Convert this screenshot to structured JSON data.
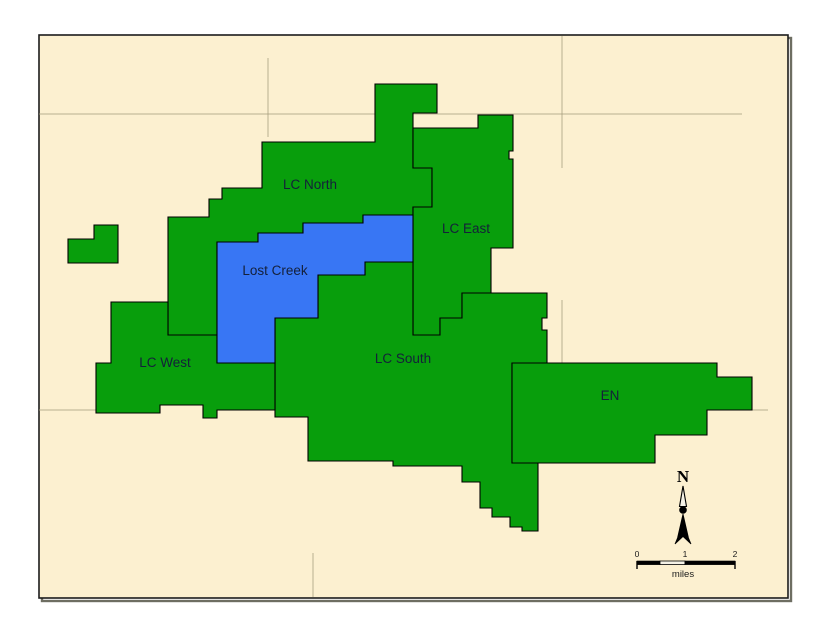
{
  "figure": {
    "type": "map",
    "title": "Lost Creek project areas map",
    "colors": {
      "page_bg": "#ffffff",
      "map_bg": "#FCF0D0",
      "green": "#089E0C",
      "blue": "#3876F4",
      "outline": "#000000",
      "frame": "#1c1c1c",
      "frame_shadow": "#6e6e62",
      "gridline": "#a89f7e",
      "label_text": "#14203a"
    },
    "frame": {
      "x": 39,
      "y": 35,
      "width": 749,
      "height": 563
    },
    "areas": [
      {
        "id": "lc-north",
        "label": "LC North",
        "fill": "green",
        "label_x": 310,
        "label_y": 189,
        "points": [
          [
            262,
            142
          ],
          [
            375,
            142
          ],
          [
            375,
            84
          ],
          [
            437,
            84
          ],
          [
            437,
            113
          ],
          [
            413,
            113
          ],
          [
            413,
            168
          ],
          [
            432,
            168
          ],
          [
            432,
            207
          ],
          [
            413,
            207
          ],
          [
            413,
            215
          ],
          [
            363,
            215
          ],
          [
            363,
            223
          ],
          [
            303,
            223
          ],
          [
            303,
            233
          ],
          [
            258,
            233
          ],
          [
            258,
            242
          ],
          [
            217,
            242
          ],
          [
            217,
            335
          ],
          [
            168,
            335
          ],
          [
            168,
            217
          ],
          [
            209,
            217
          ],
          [
            209,
            199
          ],
          [
            222,
            199
          ],
          [
            222,
            188
          ],
          [
            262,
            188
          ]
        ]
      },
      {
        "id": "lc-east",
        "label": "LC East",
        "fill": "green",
        "label_x": 466,
        "label_y": 233,
        "points": [
          [
            478,
            115
          ],
          [
            513,
            115
          ],
          [
            513,
            151
          ],
          [
            509,
            151
          ],
          [
            509,
            159
          ],
          [
            513,
            159
          ],
          [
            513,
            248
          ],
          [
            491,
            248
          ],
          [
            491,
            293
          ],
          [
            462,
            293
          ],
          [
            462,
            318
          ],
          [
            440,
            318
          ],
          [
            440,
            335
          ],
          [
            413,
            335
          ],
          [
            413,
            207
          ],
          [
            432,
            207
          ],
          [
            432,
            168
          ],
          [
            413,
            168
          ],
          [
            413,
            128
          ],
          [
            478,
            128
          ]
        ]
      },
      {
        "id": "lc-south",
        "label": "LC South",
        "fill": "green",
        "label_x": 403,
        "label_y": 363,
        "points": [
          [
            275,
            363
          ],
          [
            275,
            318
          ],
          [
            318,
            318
          ],
          [
            318,
            275
          ],
          [
            365,
            275
          ],
          [
            365,
            262
          ],
          [
            413,
            262
          ],
          [
            413,
            335
          ],
          [
            440,
            335
          ],
          [
            440,
            318
          ],
          [
            462,
            318
          ],
          [
            462,
            293
          ],
          [
            491,
            293
          ],
          [
            547,
            293
          ],
          [
            547,
            318
          ],
          [
            542,
            318
          ],
          [
            542,
            330
          ],
          [
            547,
            330
          ],
          [
            547,
            363
          ],
          [
            512,
            363
          ],
          [
            512,
            463
          ],
          [
            538,
            463
          ],
          [
            538,
            531
          ],
          [
            522,
            531
          ],
          [
            522,
            527
          ],
          [
            510,
            527
          ],
          [
            510,
            517
          ],
          [
            492,
            517
          ],
          [
            492,
            508
          ],
          [
            480,
            508
          ],
          [
            480,
            482
          ],
          [
            462,
            482
          ],
          [
            462,
            466
          ],
          [
            393,
            466
          ],
          [
            393,
            461
          ],
          [
            308,
            461
          ],
          [
            308,
            417
          ],
          [
            275,
            417
          ]
        ]
      },
      {
        "id": "lc-west",
        "label": "LC West",
        "fill": "green",
        "label_x": 165,
        "label_y": 367,
        "points": [
          [
            111,
            302
          ],
          [
            168,
            302
          ],
          [
            168,
            335
          ],
          [
            217,
            335
          ],
          [
            217,
            363
          ],
          [
            275,
            363
          ],
          [
            275,
            410
          ],
          [
            217,
            410
          ],
          [
            217,
            418
          ],
          [
            203,
            418
          ],
          [
            203,
            405
          ],
          [
            160,
            405
          ],
          [
            160,
            413
          ],
          [
            96,
            413
          ],
          [
            96,
            363
          ],
          [
            111,
            363
          ]
        ]
      },
      {
        "id": "en",
        "label": "EN",
        "fill": "green",
        "label_x": 610,
        "label_y": 400,
        "points": [
          [
            512,
            363
          ],
          [
            717,
            363
          ],
          [
            717,
            377
          ],
          [
            752,
            377
          ],
          [
            752,
            410
          ],
          [
            707,
            410
          ],
          [
            707,
            435
          ],
          [
            655,
            435
          ],
          [
            655,
            463
          ],
          [
            512,
            463
          ]
        ]
      },
      {
        "id": "west-outlier",
        "label": "",
        "fill": "green",
        "label_x": 0,
        "label_y": 0,
        "points": [
          [
            94,
            225
          ],
          [
            118,
            225
          ],
          [
            118,
            263
          ],
          [
            68,
            263
          ],
          [
            68,
            239
          ],
          [
            94,
            239
          ]
        ]
      },
      {
        "id": "lost-creek",
        "label": "Lost Creek",
        "fill": "blue",
        "label_x": 275,
        "label_y": 275,
        "points": [
          [
            217,
            242
          ],
          [
            258,
            242
          ],
          [
            258,
            233
          ],
          [
            303,
            233
          ],
          [
            303,
            223
          ],
          [
            363,
            223
          ],
          [
            363,
            215
          ],
          [
            413,
            215
          ],
          [
            413,
            262
          ],
          [
            365,
            262
          ],
          [
            365,
            275
          ],
          [
            318,
            275
          ],
          [
            318,
            318
          ],
          [
            275,
            318
          ],
          [
            275,
            363
          ],
          [
            217,
            363
          ]
        ]
      }
    ],
    "gridlines": [
      {
        "x1": 39,
        "y1": 114,
        "x2": 742,
        "y2": 114
      },
      {
        "x1": 39,
        "y1": 410,
        "x2": 130,
        "y2": 410
      },
      {
        "x1": 748,
        "y1": 410,
        "x2": 768,
        "y2": 410
      },
      {
        "x1": 268,
        "y1": 58,
        "x2": 268,
        "y2": 137
      },
      {
        "x1": 562,
        "y1": 36,
        "x2": 562,
        "y2": 168
      },
      {
        "x1": 562,
        "y1": 300,
        "x2": 562,
        "y2": 363
      },
      {
        "x1": 313,
        "y1": 553,
        "x2": 313,
        "y2": 597
      }
    ],
    "north_arrow": {
      "letter": "N"
    },
    "scale_bar": {
      "tick_labels": [
        "0",
        "1",
        "2"
      ],
      "tick_x": [
        637,
        685,
        735
      ],
      "unit": "miles"
    }
  }
}
